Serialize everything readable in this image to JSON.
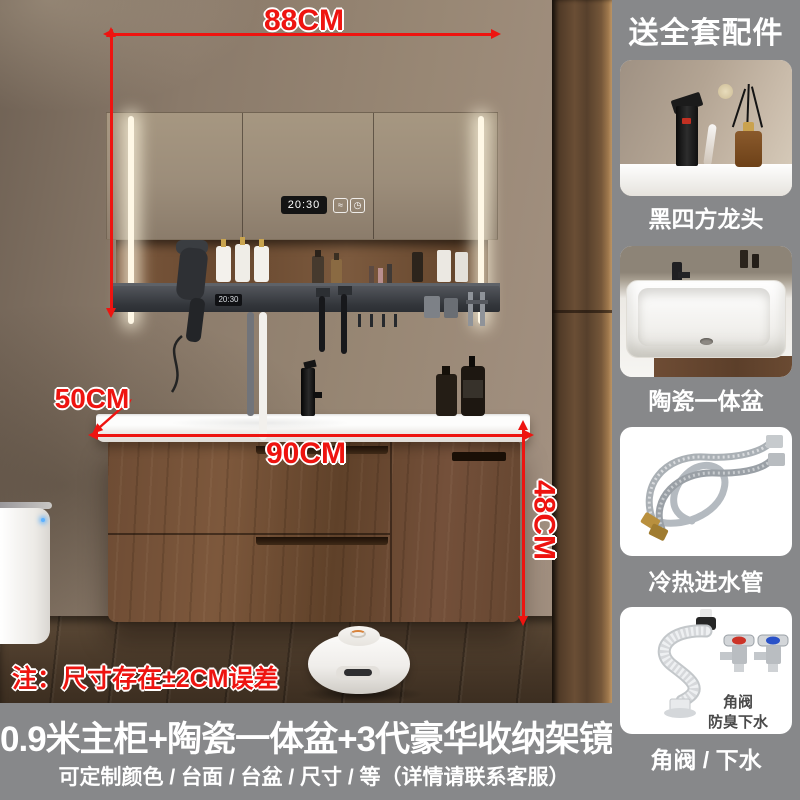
{
  "scene": {
    "dim_top_width": "88CM",
    "dim_depth": "50CM",
    "dim_bottom_width": "90CM",
    "dim_height": "48CM",
    "note": "注：尺寸存在±2CM误差",
    "mirror_clock_time": "20:30",
    "rack_clock_time": "20:30",
    "mirror_icons": {
      "defog_glyph": "≈",
      "timer_glyph": "◷"
    }
  },
  "sidebar": {
    "title": "送全套配件",
    "items": [
      {
        "label": "黑四方龙头"
      },
      {
        "label": "陶瓷一体盆"
      },
      {
        "label": "冷热进水管"
      },
      {
        "label": "角阀 / 下水",
        "badge_line1": "角阀",
        "badge_line2": "防臭下水"
      }
    ]
  },
  "banner": {
    "title": "0.9米主柜+陶瓷一体盆+3代豪华收纳架镜柜",
    "subtitle": "可定制颜色 / 台面 / 台盆 / 尺寸 / 等（详情请联系客服）"
  },
  "colors": {
    "dimension_red": "#ee1410",
    "overlay_gray": "#87888a",
    "wall_taupe": "#94826f",
    "walnut_wood": "#6b4a33",
    "counter_white": "#f7f6f3",
    "rack_charcoal": "#393c41",
    "led_white": "#fff8e6"
  }
}
